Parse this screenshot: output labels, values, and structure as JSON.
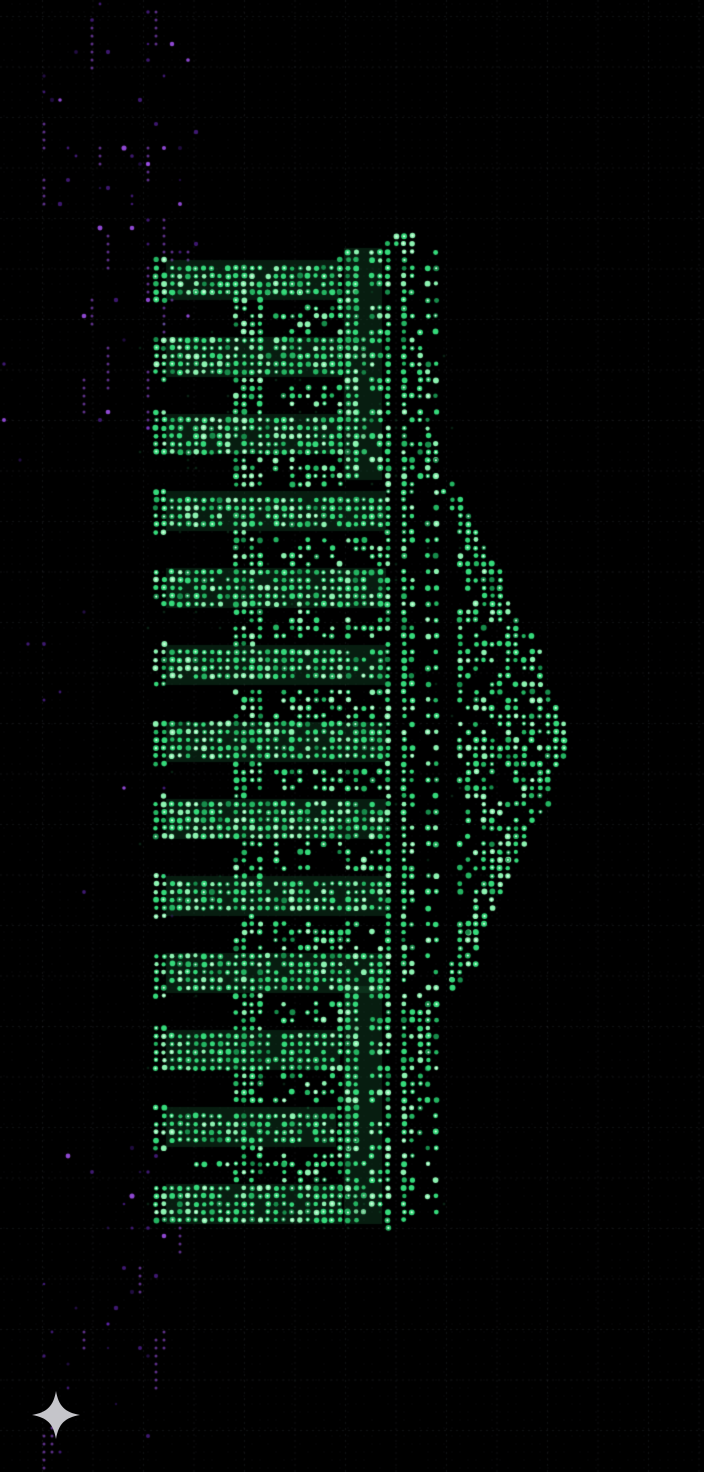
{
  "meta": {
    "width": 704,
    "height": 1472,
    "subject": "ascii-dot-matrix artwork of a classical greek temple facade rotated 90 degrees, pediment pointing right, green phosphor dots on black, purple noise haze on left edge, gray sparkle mark at bottom left"
  },
  "colors": {
    "background": "#000000",
    "grid_line": "rgba(190,200,225,0.09)",
    "lattice_dot": "rgba(150,160,190,0.055)",
    "green_bright": "#8df4b2",
    "green_main": "#35da7b",
    "green_mid": "#24b562",
    "green_dim": "#178c4b",
    "green_core": "#dcffe9",
    "green_halo": "rgba(25,105,58,0.28)",
    "green_speckle": "rgba(40,160,90,0.20)",
    "purple_bright": "#a855f7",
    "purple_main": "#7b2fe0",
    "purple_dim": "#4c1d95",
    "sparkle": "#c5c5ca"
  },
  "dot_pitch": 8,
  "grid": {
    "spacing": 50.5,
    "offset_x": 42,
    "offset_y": 16,
    "dash": [
      2,
      4
    ]
  },
  "temple": {
    "columns": {
      "count": 13,
      "first_top": 262,
      "pitch": 77,
      "thickness": 36,
      "shaft_left": 168,
      "shaft_right_wing": 338,
      "shaft_right_center": 384,
      "capital_width": 24,
      "capital_pad": 4,
      "base_x": [
        152,
        168
      ],
      "base_pad": 5,
      "density": 0.93
    },
    "center_zone": [
      478,
      988
    ],
    "gap_divider": {
      "x": [
        232,
        262
      ],
      "density": 0.8
    },
    "gap_panel": {
      "x_left": 270,
      "x_right_wing": 345,
      "x_right_center": 384,
      "density": 0.48
    },
    "wing_y": [
      [
        250,
        478
      ],
      [
        988,
        1222
      ]
    ],
    "bands_wing": [
      {
        "name": "architrave",
        "x": [
          346,
          362
        ],
        "density": 0.85
      },
      {
        "name": "frieze-panels",
        "x": [
          366,
          380
        ],
        "density": 0.9,
        "dash": [
          16,
          10
        ]
      }
    ],
    "bands_full": [
      {
        "name": "cornice-line-a",
        "x": [
          385,
          392
        ],
        "y": [
          244,
          1220
        ],
        "density": 0.95
      },
      {
        "name": "cornice-line-b",
        "x": [
          397,
          404
        ],
        "y": [
          244,
          1220
        ],
        "density": 0.95
      },
      {
        "name": "frieze-blocks",
        "x": [
          406,
          418
        ],
        "y": [
          244,
          1218
        ],
        "density": 0.85,
        "dash": [
          14,
          10
        ]
      },
      {
        "name": "dentils",
        "x": [
          422,
          438
        ],
        "y": [
          248,
          1214
        ],
        "density": 0.8,
        "dash": [
          9,
          7
        ]
      }
    ],
    "roof_wedges": [
      {
        "y": [
          248,
          476
        ],
        "x_start": 420,
        "edge_from": 406,
        "edge_to": 442,
        "density": 0.7
      },
      {
        "y": [
          990,
          1212
        ],
        "x_start": 420,
        "edge_from": 442,
        "edge_to": 406,
        "density": 0.7
      }
    ],
    "pediment": {
      "base_lines_x": [
        [
          445,
          451
        ],
        [
          453,
          459
        ]
      ],
      "base_y": [
        478,
        990
      ],
      "raking": [
        {
          "from": [
            452,
            484
          ],
          "to": [
            566,
            736
          ]
        },
        {
          "from": [
            452,
            502
          ],
          "to": [
            552,
            738
          ]
        },
        {
          "from": [
            452,
            990
          ],
          "to": [
            566,
            740
          ]
        },
        {
          "from": [
            452,
            972
          ],
          "to": [
            552,
            740
          ]
        }
      ],
      "apex": {
        "x": [
          556,
          570
        ],
        "y": [
          728,
          748
        ],
        "density": 0.8
      },
      "tympanum": {
        "base_x": 458,
        "apex_x": 544,
        "y": [
          512,
          962
        ],
        "density": 0.55
      }
    },
    "extras": [
      {
        "name": "roof-finial",
        "x": [
          392,
          413
        ],
        "y": [
          231,
          248
        ],
        "density": 0.9
      },
      {
        "name": "top-step-line",
        "x": [
          158,
          348
        ],
        "y": [
          288,
          297
        ],
        "density": 0.8
      },
      {
        "name": "bottom-step-line",
        "x": [
          185,
          400
        ],
        "y": [
          1160,
          1169
        ],
        "density": 0.7
      },
      {
        "name": "bottom-tail",
        "x": [
          386,
          403
        ],
        "y": [
          1216,
          1230
        ],
        "density": 0.6
      }
    ]
  },
  "noise": {
    "clusters": [
      {
        "name": "top-left-haze",
        "x": [
          40,
          200
        ],
        "y": [
          0,
          270
        ],
        "density": 0.1
      },
      {
        "name": "left-haze",
        "x": [
          85,
          195
        ],
        "y": [
          250,
          440
        ],
        "density": 0.075
      },
      {
        "name": "left-sparse",
        "x": [
          55,
          170
        ],
        "y": [
          440,
          950
        ],
        "density": 0.018
      },
      {
        "name": "bottom-left-haze",
        "x": [
          40,
          190
        ],
        "y": [
          1140,
          1472
        ],
        "density": 0.085
      },
      {
        "name": "edge-sparse",
        "x": [
          0,
          55
        ],
        "y": [
          0,
          1472
        ],
        "density": 0.012
      }
    ],
    "streak_count": 26,
    "green_speckle": {
      "x": [
        140,
        460
      ],
      "y": [
        245,
        1235
      ],
      "density": 0.028
    }
  },
  "sparkle": {
    "cx": 56,
    "cy": 1415,
    "size": 50
  }
}
